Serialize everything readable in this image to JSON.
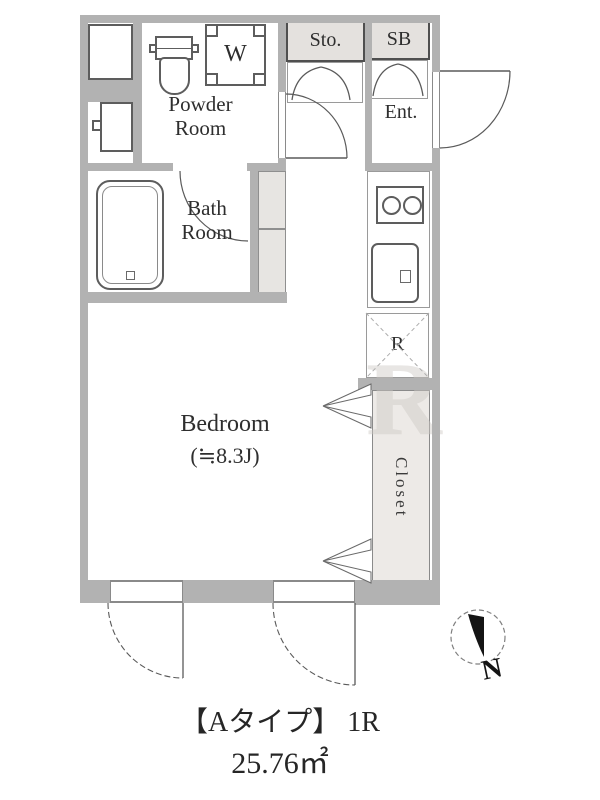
{
  "plan": {
    "caption_line1": "【Aタイプ】 1R",
    "caption_line2": "25.76㎡",
    "rooms": {
      "powder_room": {
        "line1": "Powder",
        "line2": "Room"
      },
      "bath_room": {
        "line1": "Bath",
        "line2": "Room"
      },
      "bedroom": {
        "name": "Bedroom",
        "size": "(≒8.3J)"
      },
      "entrance": {
        "label": "Ent."
      },
      "storage": {
        "label": "Sto."
      },
      "shoe_box": {
        "label": "SB"
      },
      "closet": {
        "label": "Closet"
      },
      "refrigerator_space": {
        "label": "R"
      },
      "washing_machine": {
        "label": "W"
      }
    },
    "compass": {
      "label": "N"
    },
    "watermark": {
      "text": "R"
    }
  },
  "colors": {
    "wall": "#b2b2b2",
    "wall_edge": "#8a8a8a",
    "shade_fill": "#e4e1de",
    "closet_fill": "#edeae7",
    "fixture_line": "#5d5d5d",
    "text": "#2e2e2e",
    "background": "#ffffff",
    "compass_black": "#141414"
  }
}
